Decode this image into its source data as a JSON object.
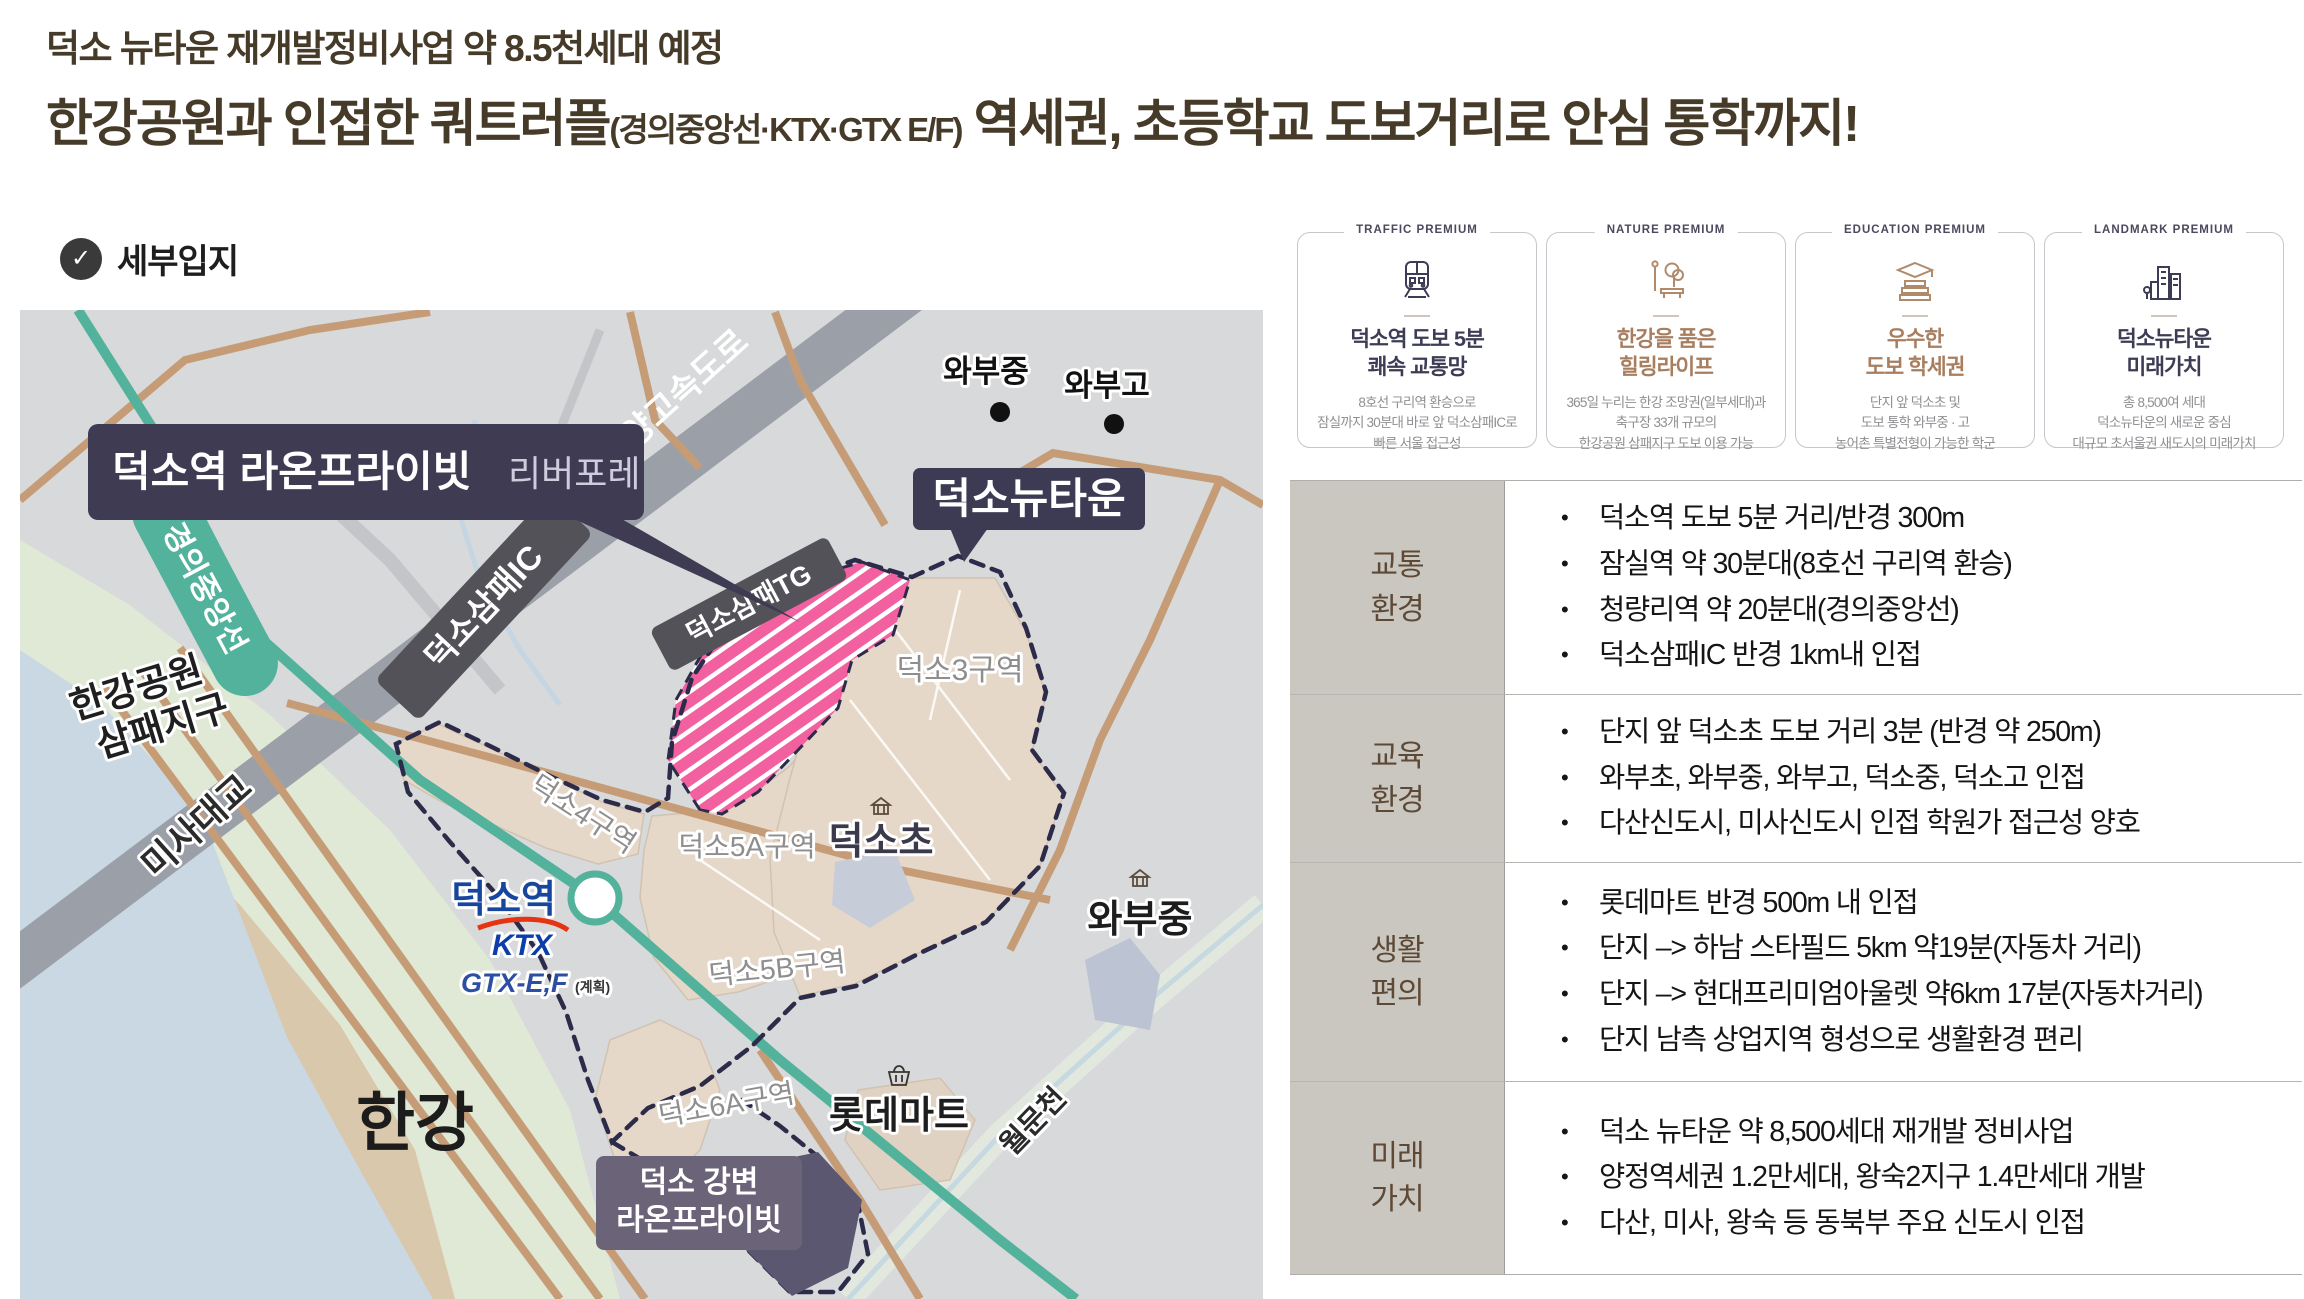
{
  "title": {
    "line1": "덕소 뉴타운 재개발정비사업 약 8.5천세대 예정",
    "line2_main": "한강공원과 인접한 쿼트러플",
    "line2_paren": "(경의중앙선·KTX·GTX E/F)",
    "line2_rest": " 역세권, 초등학교 도보거리로 안심 통학까지!"
  },
  "section": {
    "label": "세부입지"
  },
  "premium_cards": [
    {
      "tag": "TRAFFIC PREMIUM",
      "icon": "train-icon",
      "title1": "덕소역 도보 5분",
      "title2": "쾌속 교통망",
      "body1": "8호선 구리역 환승으로",
      "body2": "잠실까지 30분대 바로 앞 덕소삼패IC로",
      "body3": "빠른 서울 접근성"
    },
    {
      "tag": "NATURE PREMIUM",
      "icon": "park-icon",
      "title1": "한강을 품은",
      "title2": "힐링라이프",
      "body1": "365일 누리는 한강 조망권(일부세대)과",
      "body2": "축구장 33개 규모의",
      "body3": "한강공원 삼패지구 도보 이용 가능"
    },
    {
      "tag": "EDUCATION PREMIUM",
      "icon": "graduation-icon",
      "title1": "우수한",
      "title2": "도보 학세권",
      "body1": "단지 앞 덕소초 및",
      "body2": "도보 통학 와부중 · 고",
      "body3": "농어촌 특별전형이 가능한 학군"
    },
    {
      "tag": "LANDMARK PREMIUM",
      "icon": "buildings-icon",
      "title1": "덕소뉴타운",
      "title2": "미래가치",
      "body1": "총 8,500여 세대",
      "body2": "덕소뉴타운의 새로운 중심",
      "body3": "대규모 초서울권 새도시의 미래가치"
    }
  ],
  "info_table": {
    "rows": [
      {
        "label_line1": "교통",
        "label_line2": "환경",
        "items": [
          "덕소역 도보 5분 거리/반경 300m",
          "잠실역 약 30분대(8호선 구리역 환승)",
          "청량리역 약 20분대(경의중앙선)",
          "덕소삼패IC 반경 1km내 인접"
        ]
      },
      {
        "label_line1": "교육",
        "label_line2": "환경",
        "items": [
          "단지 앞 덕소초 도보 거리 3분 (반경 약 250m)",
          "와부초, 와부중, 와부고, 덕소중, 덕소고 인접",
          "다산신도시, 미사신도시 인접 학원가 접근성 양호"
        ]
      },
      {
        "label_line1": "생활",
        "label_line2": "편의",
        "items": [
          "롯데마트 반경 500m 내 인접",
          "단지 –> 하남 스타필드 5km 약19분(자동차 거리)",
          "단지 –> 현대프리미엄아울렛 약6km 17분(자동차거리)",
          "단지 남측 상업지역 형성으로 생활환경 편리"
        ]
      },
      {
        "label_line1": "미래",
        "label_line2": "가치",
        "items": [
          "덕소 뉴타운 약 8,500세대 재개발 정비사업",
          "양정역세권 1.2만세대, 왕숙2지구 1.4만세대 개발",
          "다산, 미사, 왕숙 등 동북부 주요 신도시 인접"
        ]
      }
    ]
  },
  "map": {
    "banner_main": "덕소역 라온프라이빗",
    "banner_sub": "리버포레",
    "rail_line": "경의중앙선",
    "park_line1": "한강공원",
    "park_line2": "삼패지구",
    "bridge": "미사대교",
    "highway": "서울~양양고속도로",
    "ic_badge": "덕소삼패IC",
    "tg_badge": "덕소삼패TG",
    "newtown_badge": "덕소뉴타운",
    "wabu_middle_top": "와부중",
    "wabu_high": "와부고",
    "zone3": "덕소3구역",
    "zone4": "덕소4구역",
    "zone5a": "덕소5A구역",
    "zone5b": "덕소5B구역",
    "zone6a": "덕소6A구역",
    "deokso_elementary": "덕소초",
    "station": "덕소역",
    "ktx": "KTX",
    "gtx": "GTX",
    "gtx_suffix": "-E,F",
    "gtx_note": "(계획)",
    "mart": "롯데마트",
    "wabu_middle_bottom": "와부중",
    "stream": "월문천",
    "river": "한강",
    "badge2_line1": "덕소 강변",
    "badge2_line2": "라온프라이빗",
    "colors": {
      "accent_navy": "#3d3c55",
      "accent_brown": "#a87e5f",
      "zone_pink": "#f2609f",
      "rail_teal": "#53b29c",
      "boundary_navy": "#2c2b4a",
      "station_blue": "#17469e",
      "ktx_blue": "#0b3ea8",
      "ktx_red": "#e63312",
      "gtx_green": "#6fae3e"
    }
  }
}
